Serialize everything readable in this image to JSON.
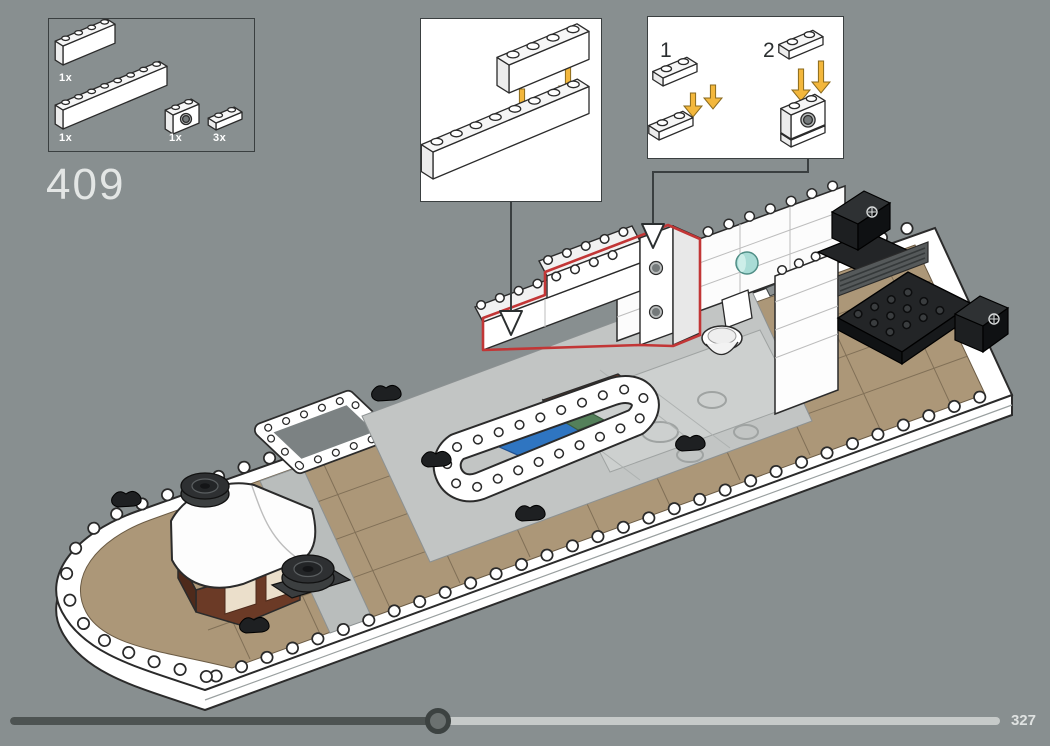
{
  "step": {
    "number": "409"
  },
  "parts_box": {
    "parts": [
      {
        "icon": "brick-1x4-white-icon",
        "qty_label": "1x"
      },
      {
        "icon": "brick-1x8-white-icon",
        "qty_label": "1x"
      },
      {
        "icon": "technic-brick-1x2-hole-white-icon",
        "qty_label": "1x"
      },
      {
        "icon": "plate-1x2-white-icon",
        "qty_label": "3x"
      }
    ]
  },
  "callouts": {
    "stack_detail": {
      "icons": [
        "brick-1x4-white-icon",
        "brick-1x8-white-icon",
        "assembly-arrow-icon"
      ]
    },
    "sub_steps": [
      {
        "label": "1",
        "icons": [
          "plate-1x2-white-icon",
          "plate-1x2-white-icon",
          "assembly-arrow-icon"
        ]
      },
      {
        "label": "2",
        "icons": [
          "plate-1x2-white-icon",
          "technic-brick-1x2-hole-white-icon",
          "assembly-arrow-icon"
        ]
      }
    ]
  },
  "progress": {
    "page_number": "327",
    "fraction": 0.43
  },
  "colors": {
    "background": "#888F90",
    "panel_border": "#3A3F40",
    "callout_bg": "#FFFFFF",
    "step_text": "#E3E6E5",
    "qty_text": "#FFFFFF",
    "substep_text": "#2B2F30",
    "highlight_red": "#C23636",
    "arrow_yellow": "#F3B73C",
    "deck_tan": "#AC9778",
    "deck_seam": "#73634C",
    "hull_white": "#FFFFFF",
    "line_dark": "#2B2B2B",
    "cabin_gray": "#C2C5C4",
    "tile_gray": "#CDD0CF",
    "wood_brown": "#6B3A26",
    "wood_brown_dark": "#4E2A1B",
    "bed_blue": "#2F75C1",
    "bed_blue_dark": "#1F4F8F",
    "bed_green": "#54805A",
    "porthole_teal": "#A9DCD6",
    "piece_black": "#232527",
    "grille_gray": "#55595A",
    "progress_fill": "#4D5352",
    "progress_track": "#C6CAC9",
    "progress_handle": "#6B7170",
    "page_number_text": "#DFE2E1"
  }
}
